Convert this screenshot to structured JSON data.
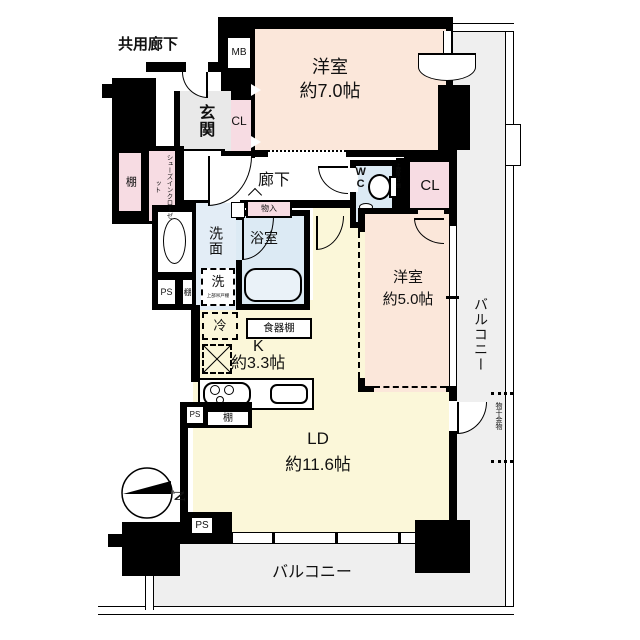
{
  "floorplan": {
    "outside": {
      "shared_corridor": "共用廊下"
    },
    "entrance": {
      "name": "玄関",
      "shoe_closet": "シューズインクローゼット",
      "shelf": "棚",
      "meter_box": "MB"
    },
    "rooms": {
      "west7": {
        "name": "洋室",
        "size": "約7.0帖",
        "closet": "CL"
      },
      "west5": {
        "name": "洋室",
        "size": "約5.0帖",
        "closet": "CL"
      },
      "ld": {
        "name": "LD",
        "size": "約11.6帖"
      },
      "kitchen": {
        "name": "K",
        "size": "約3.3帖",
        "cupboard": "食器棚",
        "fridge": "冷",
        "shelf": "棚"
      },
      "corridor": {
        "name": "廊下",
        "storage": "物入"
      },
      "washroom": {
        "name": "洗面",
        "washer": "洗",
        "washer_note": "上部吊戸棚",
        "shelf": "棚",
        "ps": "PS"
      },
      "bathroom": {
        "name": "浴室"
      },
      "toilet": {
        "name": "WC",
        "shelf_note": "上部吊戸棚"
      }
    },
    "balcony": {
      "name_right": "バルコニー",
      "name_bottom": "バルコニー",
      "drying_fixture": "物干金物"
    },
    "misc": {
      "ps_kitchen": "PS",
      "ps_bottom": "PS",
      "north": "N"
    },
    "colors": {
      "wall": "#000000",
      "bedroom": "#fbe7da",
      "living": "#fbf7d9",
      "closet": "#f7dce3",
      "wet_area": "#dceaf4",
      "washroom": "#e3edf6",
      "entrance": "#e9e9e9",
      "balcony": "#efefef"
    }
  }
}
